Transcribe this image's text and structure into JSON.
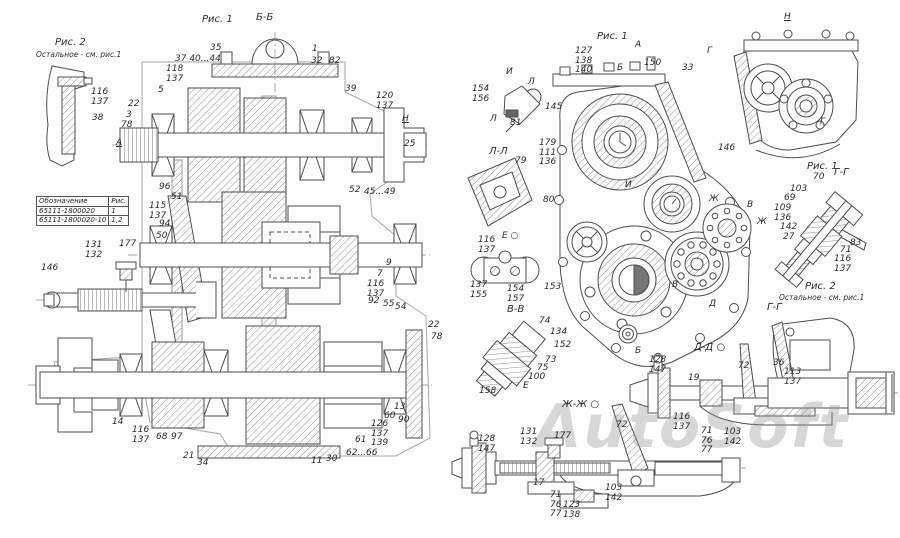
{
  "watermark": "AutoSoft",
  "parts_table": {
    "headers": [
      "Обозначение",
      "Рис."
    ],
    "rows": [
      [
        "65111-1800020",
        "1"
      ],
      [
        "65111-1800020-10",
        "1,2"
      ]
    ]
  },
  "callouts": [
    {
      "text": "Рис. 2",
      "x": 55,
      "y": 38,
      "style": "title"
    },
    {
      "text": "Остальное - см. рис.1",
      "x": 36,
      "y": 50,
      "style": "small"
    },
    {
      "text": "116\n137",
      "x": 91,
      "y": 88
    },
    {
      "text": "38",
      "x": 92,
      "y": 114
    },
    {
      "text": "Рис. 1",
      "x": 202,
      "y": 15,
      "style": "title"
    },
    {
      "text": "Б-Б",
      "x": 256,
      "y": 13,
      "style": "title"
    },
    {
      "text": "37 40...44",
      "x": 175,
      "y": 55
    },
    {
      "text": "118\n137",
      "x": 166,
      "y": 65
    },
    {
      "text": "35",
      "x": 210,
      "y": 44
    },
    {
      "text": "1",
      "x": 312,
      "y": 45
    },
    {
      "text": "32",
      "x": 311,
      "y": 57
    },
    {
      "text": "82",
      "x": 329,
      "y": 57
    },
    {
      "text": "39",
      "x": 345,
      "y": 85
    },
    {
      "text": "120\n137",
      "x": 376,
      "y": 92
    },
    {
      "text": "Н",
      "x": 402,
      "y": 115,
      "style": "u"
    },
    {
      "text": "25",
      "x": 404,
      "y": 140
    },
    {
      "text": "5",
      "x": 158,
      "y": 86
    },
    {
      "text": "22",
      "x": 128,
      "y": 100
    },
    {
      "text": "3",
      "x": 126,
      "y": 111
    },
    {
      "text": "78",
      "x": 121,
      "y": 121
    },
    {
      "text": "А",
      "x": 116,
      "y": 139,
      "style": "u"
    },
    {
      "text": "96",
      "x": 159,
      "y": 183
    },
    {
      "text": "51",
      "x": 171,
      "y": 193
    },
    {
      "text": "115\n137",
      "x": 149,
      "y": 202
    },
    {
      "text": "94",
      "x": 159,
      "y": 220
    },
    {
      "text": "50",
      "x": 156,
      "y": 232
    },
    {
      "text": "146",
      "x": 41,
      "y": 264
    },
    {
      "text": "131\n132",
      "x": 85,
      "y": 241
    },
    {
      "text": "177",
      "x": 119,
      "y": 240
    },
    {
      "text": "52",
      "x": 349,
      "y": 186
    },
    {
      "text": "45...49",
      "x": 364,
      "y": 188
    },
    {
      "text": "9",
      "x": 386,
      "y": 259
    },
    {
      "text": "7",
      "x": 377,
      "y": 270
    },
    {
      "text": "116\n137",
      "x": 367,
      "y": 280
    },
    {
      "text": "92",
      "x": 368,
      "y": 297
    },
    {
      "text": "55",
      "x": 383,
      "y": 300
    },
    {
      "text": "54",
      "x": 395,
      "y": 303
    },
    {
      "text": "22",
      "x": 428,
      "y": 321
    },
    {
      "text": "78",
      "x": 431,
      "y": 333
    },
    {
      "text": "14",
      "x": 112,
      "y": 418
    },
    {
      "text": "116\n137",
      "x": 132,
      "y": 426
    },
    {
      "text": "68",
      "x": 156,
      "y": 433
    },
    {
      "text": "97",
      "x": 171,
      "y": 433
    },
    {
      "text": "21",
      "x": 183,
      "y": 452
    },
    {
      "text": "34",
      "x": 197,
      "y": 459
    },
    {
      "text": "11",
      "x": 311,
      "y": 457
    },
    {
      "text": "30",
      "x": 326,
      "y": 455
    },
    {
      "text": "62...66",
      "x": 346,
      "y": 449
    },
    {
      "text": "61",
      "x": 355,
      "y": 436
    },
    {
      "text": "126\n137\n139",
      "x": 371,
      "y": 420
    },
    {
      "text": "60",
      "x": 384,
      "y": 412
    },
    {
      "text": "90",
      "x": 398,
      "y": 416
    },
    {
      "text": "13",
      "x": 394,
      "y": 403
    },
    {
      "text": "Рис. 1",
      "x": 597,
      "y": 32,
      "style": "title"
    },
    {
      "text": "А",
      "x": 635,
      "y": 41
    },
    {
      "text": "127\n138\n140",
      "x": 575,
      "y": 47
    },
    {
      "text": "Б",
      "x": 617,
      "y": 64
    },
    {
      "text": "150",
      "x": 644,
      "y": 59
    },
    {
      "text": "33",
      "x": 682,
      "y": 64
    },
    {
      "text": "Н",
      "x": 784,
      "y": 13,
      "style": "u"
    },
    {
      "text": "Г",
      "x": 707,
      "y": 47
    },
    {
      "text": "Г",
      "x": 820,
      "y": 118
    },
    {
      "text": "146",
      "x": 718,
      "y": 144
    },
    {
      "text": "И",
      "x": 506,
      "y": 68
    },
    {
      "text": "Л",
      "x": 528,
      "y": 78
    },
    {
      "text": "154\n156",
      "x": 472,
      "y": 85
    },
    {
      "text": "81",
      "x": 510,
      "y": 119
    },
    {
      "text": "Л",
      "x": 490,
      "y": 115
    },
    {
      "text": "145",
      "x": 545,
      "y": 103
    },
    {
      "text": "179\n111\n136",
      "x": 539,
      "y": 139
    },
    {
      "text": "Л-Л",
      "x": 489,
      "y": 147,
      "style": "title"
    },
    {
      "text": "79",
      "x": 515,
      "y": 157
    },
    {
      "text": "80",
      "x": 543,
      "y": 196
    },
    {
      "text": "Е ○",
      "x": 502,
      "y": 232
    },
    {
      "text": "116\n137",
      "x": 478,
      "y": 236
    },
    {
      "text": "137\n155",
      "x": 470,
      "y": 281
    },
    {
      "text": "154\n157",
      "x": 507,
      "y": 285
    },
    {
      "text": "153",
      "x": 544,
      "y": 283
    },
    {
      "text": "В-В",
      "x": 507,
      "y": 305,
      "style": "title"
    },
    {
      "text": "74",
      "x": 539,
      "y": 317
    },
    {
      "text": "134",
      "x": 550,
      "y": 328
    },
    {
      "text": "152",
      "x": 554,
      "y": 341
    },
    {
      "text": "73",
      "x": 545,
      "y": 356
    },
    {
      "text": "75",
      "x": 537,
      "y": 364
    },
    {
      "text": "100",
      "x": 528,
      "y": 373
    },
    {
      "text": "158",
      "x": 479,
      "y": 387
    },
    {
      "text": "Е",
      "x": 523,
      "y": 382
    },
    {
      "text": "И",
      "x": 625,
      "y": 181
    },
    {
      "text": "Ж",
      "x": 709,
      "y": 195
    },
    {
      "text": "В",
      "x": 747,
      "y": 201
    },
    {
      "text": "Ж",
      "x": 757,
      "y": 218
    },
    {
      "text": "В",
      "x": 672,
      "y": 281
    },
    {
      "text": "Д",
      "x": 709,
      "y": 300
    },
    {
      "text": "Б",
      "x": 635,
      "y": 347
    },
    {
      "text": "Рис. 1",
      "x": 807,
      "y": 162,
      "style": "title"
    },
    {
      "text": "Г-Г",
      "x": 834,
      "y": 168,
      "style": "title"
    },
    {
      "text": "70",
      "x": 813,
      "y": 173
    },
    {
      "text": "103",
      "x": 790,
      "y": 185
    },
    {
      "text": "69",
      "x": 784,
      "y": 194
    },
    {
      "text": "109\n136",
      "x": 774,
      "y": 204
    },
    {
      "text": "142",
      "x": 780,
      "y": 223
    },
    {
      "text": "27",
      "x": 783,
      "y": 233
    },
    {
      "text": "83",
      "x": 850,
      "y": 239
    },
    {
      "text": "71",
      "x": 840,
      "y": 246
    },
    {
      "text": "116\n137",
      "x": 834,
      "y": 255
    },
    {
      "text": "Рис. 2",
      "x": 805,
      "y": 282,
      "style": "title"
    },
    {
      "text": "Остальное - см. рис.1",
      "x": 779,
      "y": 293,
      "style": "small"
    },
    {
      "text": "Г-Г",
      "x": 767,
      "y": 303,
      "style": "title"
    },
    {
      "text": "36",
      "x": 773,
      "y": 359
    },
    {
      "text": "113\n137",
      "x": 784,
      "y": 368
    },
    {
      "text": "Д-Д ○",
      "x": 694,
      "y": 343,
      "style": "title"
    },
    {
      "text": "72",
      "x": 738,
      "y": 362
    },
    {
      "text": "128\n147",
      "x": 649,
      "y": 356
    },
    {
      "text": "19",
      "x": 688,
      "y": 374
    },
    {
      "text": "116\n137",
      "x": 673,
      "y": 413
    },
    {
      "text": "71\n76\n77",
      "x": 701,
      "y": 427
    },
    {
      "text": "103\n142",
      "x": 724,
      "y": 428
    },
    {
      "text": "Ж-Ж ○",
      "x": 562,
      "y": 400,
      "style": "title"
    },
    {
      "text": "128\n147",
      "x": 478,
      "y": 435
    },
    {
      "text": "131\n132",
      "x": 520,
      "y": 428
    },
    {
      "text": "177",
      "x": 554,
      "y": 432
    },
    {
      "text": "72",
      "x": 616,
      "y": 421
    },
    {
      "text": "17",
      "x": 533,
      "y": 479
    },
    {
      "text": "71\n76\n77",
      "x": 550,
      "y": 491
    },
    {
      "text": "123\n138",
      "x": 563,
      "y": 501
    },
    {
      "text": "103\n142",
      "x": 605,
      "y": 484
    }
  ]
}
